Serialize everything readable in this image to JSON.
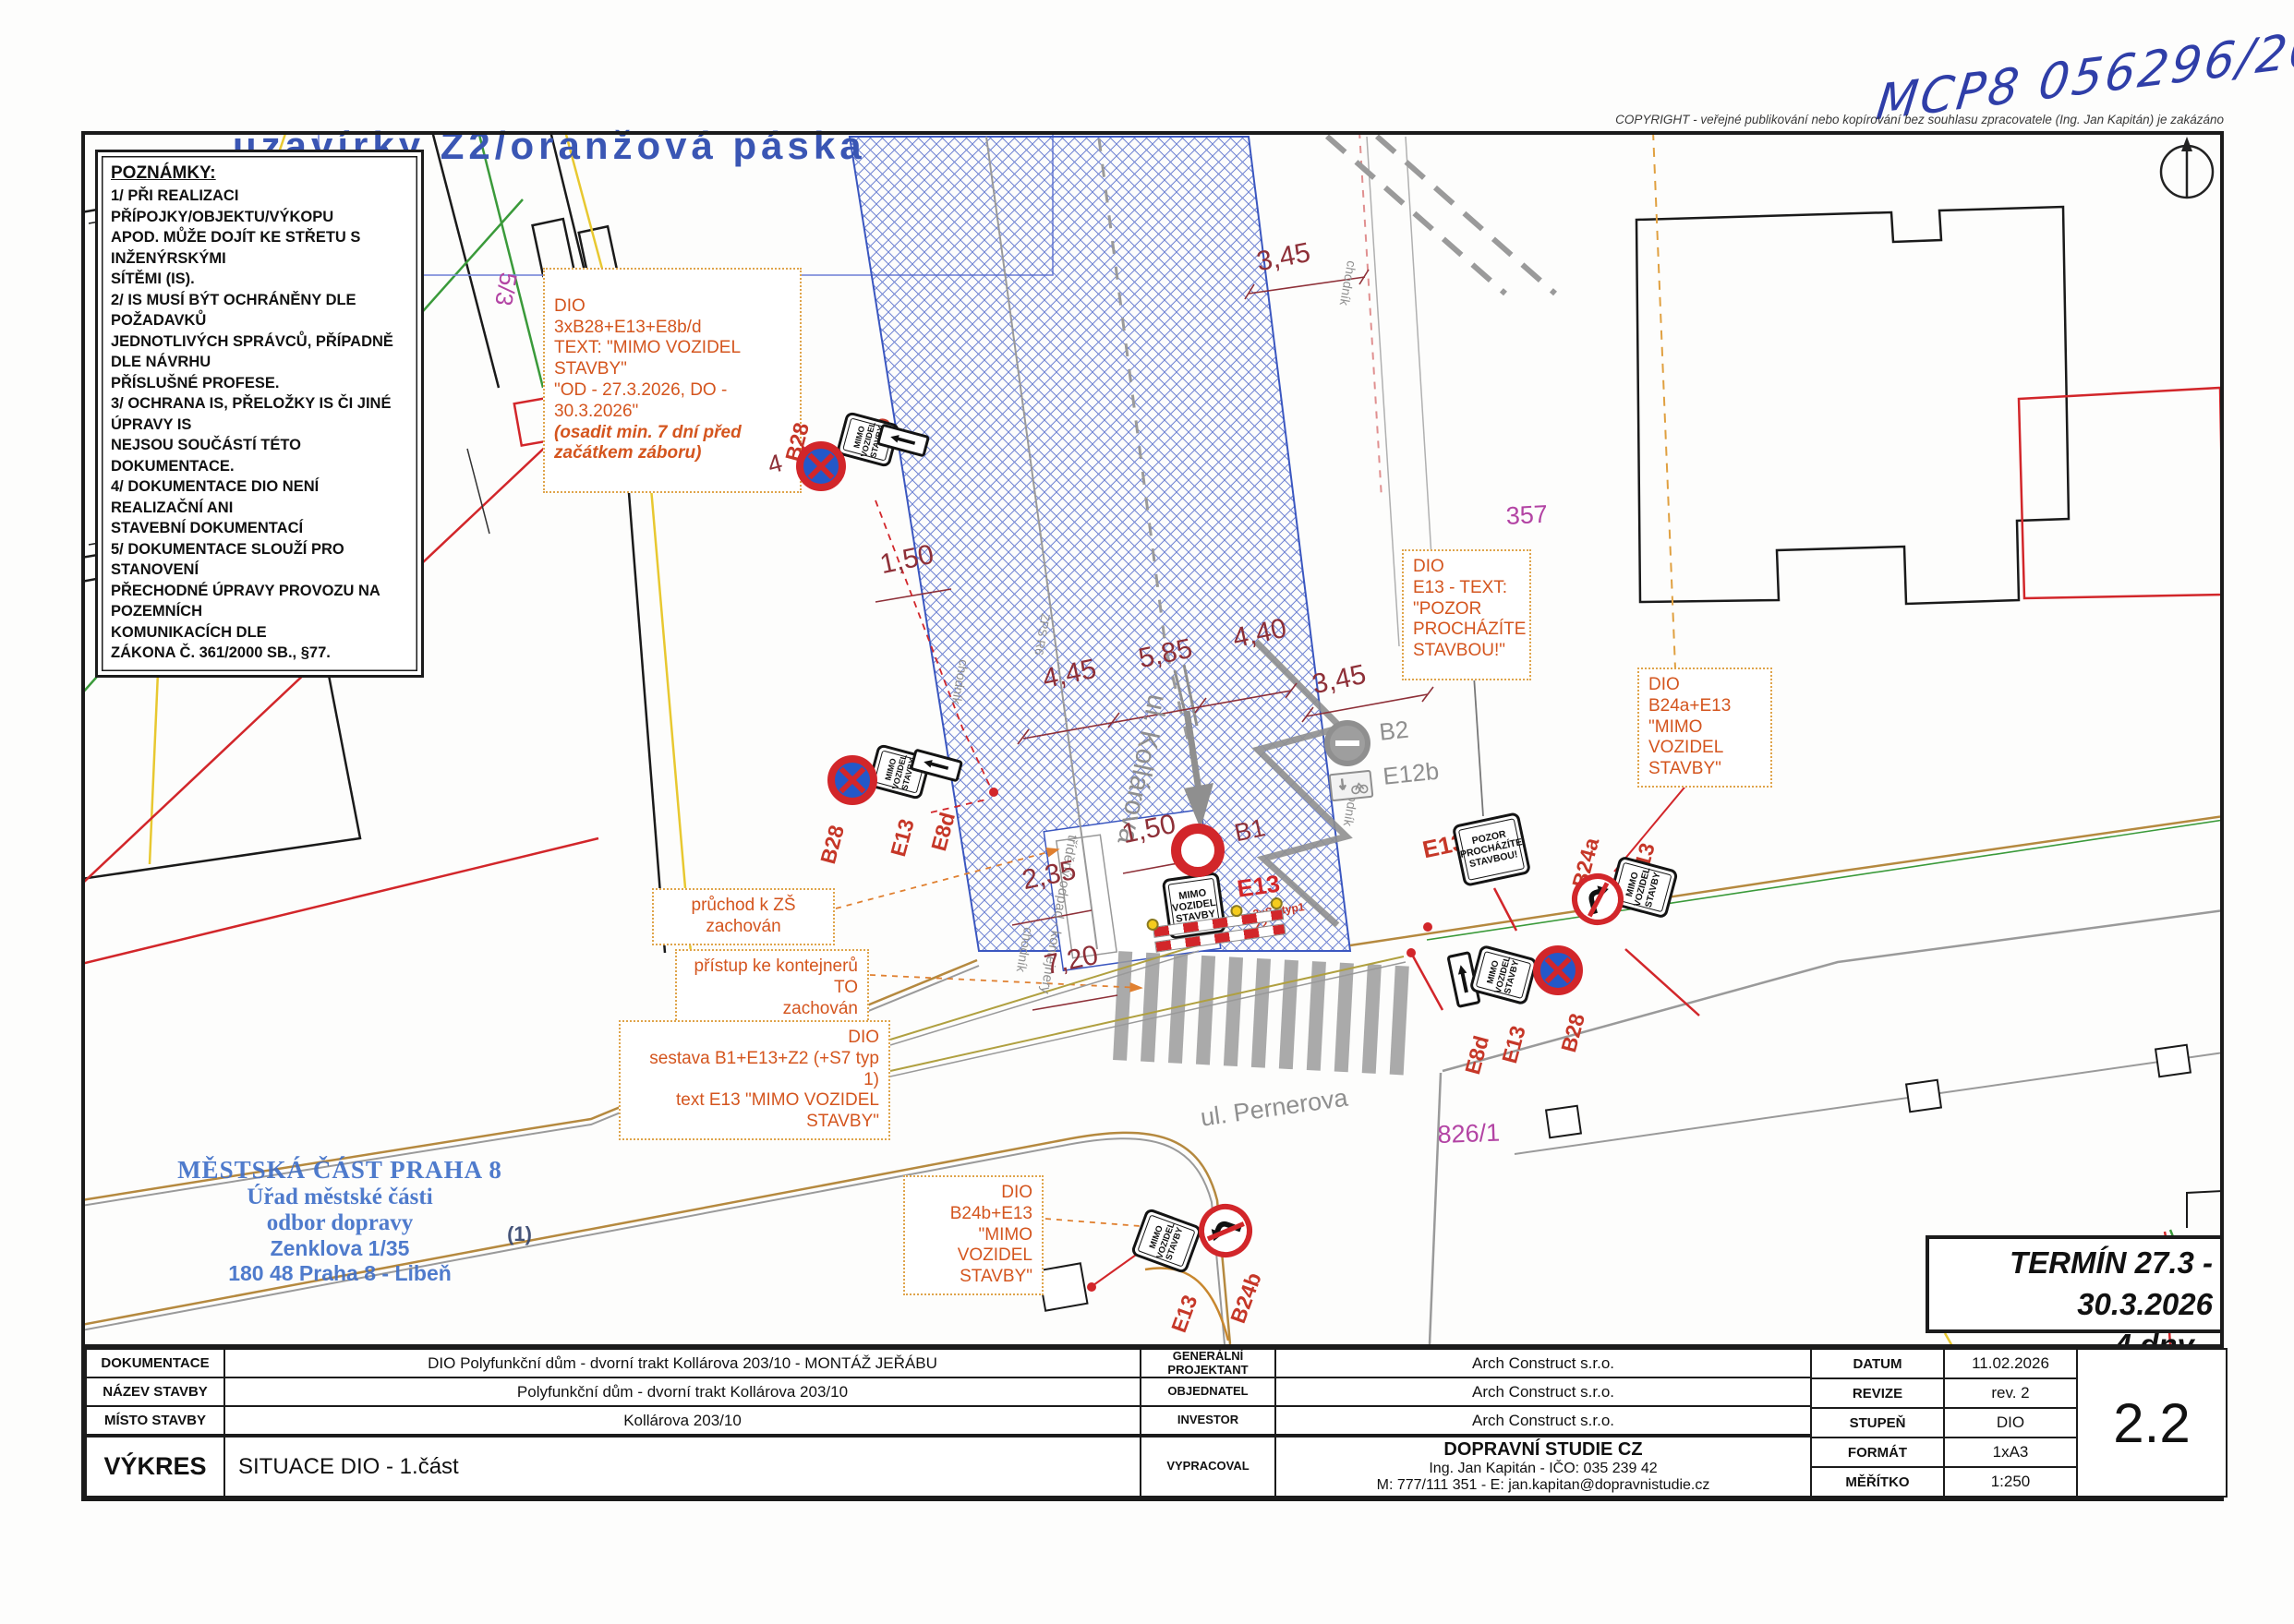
{
  "page": {
    "top_label": "uzavírky Z2/oranžová páska"
  },
  "header": {
    "handwritten_ref": "MCP8 056296/2026",
    "copyright": "COPYRIGHT - veřejné publikování nebo kopírování bez souhlasu zpracovatele (Ing. Jan Kapitán) je zakázáno"
  },
  "notes": {
    "title": "POZNÁMKY:",
    "body": "1/ PŘI REALIZACI PŘÍPOJKY/OBJEKTU/VÝKOPU\nAPOD. MŮŽE DOJÍT KE STŘETU S INŽENÝRSKÝMI\nSÍTĚMI (IS).\n2/ IS MUSÍ BÝT OCHRÁNĚNY DLE POŽADAVKŮ\nJEDNOTLIVÝCH SPRÁVCŮ, PŘÍPADNĚ DLE NÁVRHU\nPŘÍSLUŠNÉ PROFESE.\n3/ OCHRANA IS, PŘELOŽKY IS ČI JINÉ ÚPRAVY IS\nNEJSOU SOUČÁSTÍ TÉTO DOKUMENTACE.\n4/ DOKUMENTACE DIO NENÍ REALIZAČNÍ ANI\nSTAVEBNÍ DOKUMENTACÍ\n5/ DOKUMENTACE SLOUŽÍ PRO STANOVENÍ\nPŘECHODNÉ ÚPRAVY PROVOZU NA POZEMNÍCH\nKOMUNIKACÍCH DLE\nZÁKONA Č. 361/2000 SB., §77."
  },
  "annotations": {
    "a_main": "DIO\n3xB28+E13+E8b/d\nTEXT: \"MIMO VOZIDEL STAVBY\"\n\"OD - 27.3.2026, DO - 30.3.2026\"",
    "a_note": "(osadit min. 7 dní před\nzačátkem záboru)",
    "b": "DIO\nE13 - TEXT:\n\"POZOR\nPROCHÁZÍTE\nSTAVBOU!\"",
    "c": "DIO\nB24a+E13\n\"MIMO VOZIDEL\nSTAVBY\"",
    "d": "průchod k ZŠ zachován",
    "e": "přístup ke kontejnerů TO\nzachován",
    "f": "DIO\nsestava B1+E13+Z2 (+S7 typ 1)\ntext E13 \"MIMO VOZIDEL STAVBY\"",
    "g": "DIO\nB24b+E13\n\"MIMO VOZIDEL\nSTAVBY\""
  },
  "signs": {
    "mimo_text": "MIMO\nVOZIDEL\nSTAVBY",
    "pozor_text": "POZOR\nPROCHÁZÍTE\nSTAVBOU!",
    "labels": {
      "b28": "B28",
      "e13": "E13",
      "e8b": "E8b",
      "e8d": "E8d",
      "b1": "B1",
      "b2": "B2",
      "e12b": "E12b",
      "b24a": "B24a",
      "b24b": "B24b",
      "count4": "4",
      "s7z2": "3xS7 typ1\nZ2"
    }
  },
  "dimensions": {
    "top345": "3,45",
    "d150a": "1,50",
    "d445": "4,45",
    "d585": "5,85",
    "d440": "4,40",
    "r345": "3,45",
    "d150b": "1,50",
    "d235": "2,35",
    "d720": "7,20"
  },
  "parcels": {
    "p55": "5/5",
    "p53": "5/3",
    "p357": "357",
    "p8261": "826/1"
  },
  "labels": {
    "kollarova": "ul. Kollárova",
    "pernerova": "ul. Pernerova",
    "chodnik": "chodník",
    "trideny": "tříděný odpad - kontejnery",
    "zps": "ZPS R6"
  },
  "stamp": {
    "l1": "MĚSTSKÁ ČÁST PRAHA 8",
    "l2": "Úřad městské části",
    "l3": "odbor dopravy",
    "l4": "Zenklova 1/35",
    "l5": "180 48 Praha 8 - Libeň",
    "mark": "(1)"
  },
  "termin": {
    "text": "TERMÍN 27.3 - 30.3.2026\n4 dny - PÁ,SO,NE,PO"
  },
  "titleblock": {
    "rows_left": [
      {
        "label": "DOKUMENTACE",
        "value": "DIO Polyfunkční dům - dvorní trakt Kollárova 203/10 - MONTÁŽ JEŘÁBU"
      },
      {
        "label": "NÁZEV STAVBY",
        "value": "Polyfunkční dům - dvorní trakt Kollárova 203/10"
      },
      {
        "label": "MÍSTO STAVBY",
        "value": "Kollárova 203/10"
      }
    ],
    "vykres": {
      "label": "VÝKRES",
      "value": "SITUACE DIO - 1.část"
    },
    "rows_mid": [
      {
        "label": "GENERÁLNÍ\nPROJEKTANT",
        "value": "Arch Construct s.r.o."
      },
      {
        "label": "OBJEDNATEL",
        "value": "Arch Construct s.r.o."
      },
      {
        "label": "INVESTOR",
        "value": "Arch Construct s.r.o."
      }
    ],
    "vypracoval": {
      "label": "VYPRACOVAL",
      "line1": "DOPRAVNÍ STUDIE CZ",
      "line2": "Ing. Jan Kapitán - IČO: 035 239 42",
      "line3": "M: 777/111 351 - E: jan.kapitan@dopravnistudie.cz"
    },
    "rows_right": [
      {
        "label": "DATUM",
        "value": "11.02.2026"
      },
      {
        "label": "REVIZE",
        "value": "rev. 2"
      },
      {
        "label": "STUPEŇ",
        "value": "DIO"
      },
      {
        "label": "FORMÁT",
        "value": "1xA3"
      },
      {
        "label": "MĚŘÍTKO",
        "value": "1:250"
      }
    ],
    "sheet_number": "2.2"
  },
  "colors": {
    "hatch_blue": "#4a63c8",
    "sign_red": "#D2262A",
    "annotation_orange": "#D4551E",
    "dim_maroon": "#8E3038",
    "parcel_magenta": "#B344A4",
    "stamp_blue": "#4170C8"
  }
}
